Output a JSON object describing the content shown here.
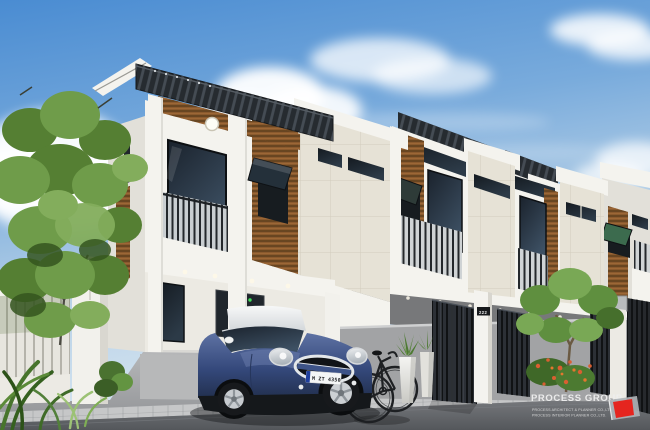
{
  "scene": {
    "label": "3d-architectural-rendering-modern-townhouse-row"
  },
  "watermark": {
    "title": "PROCESS GROUP",
    "subtitle_line1": "PROCESS ARCHITECT & PLANNER CO.,LTD.",
    "subtitle_line2": "PROCESS INTERIOR PLANNER CO.,LTD."
  },
  "car": {
    "label": "mini-cooper-hatchback",
    "license_plate": "M ZT 4350"
  },
  "gate": {
    "house_number": "222"
  },
  "colors": {
    "sky_top": "#4a8cd2",
    "sky_bottom": "#dbe8f2",
    "wall_white": "#f4f3ee",
    "wall_shade": "#e2e0d9",
    "panel_cream": "#e6e2d6",
    "wood_brown": "#8a5a2e",
    "canopy_dark": "#262b30",
    "window_glass": "#1c242c",
    "foliage_green": "#6f9c4a",
    "flower_orange": "#d95f31",
    "car_blue": "#3c5288",
    "car_roof": "#f2f3f2",
    "pavement_gray": "#7d8085",
    "logo_red": "#e5251f"
  }
}
